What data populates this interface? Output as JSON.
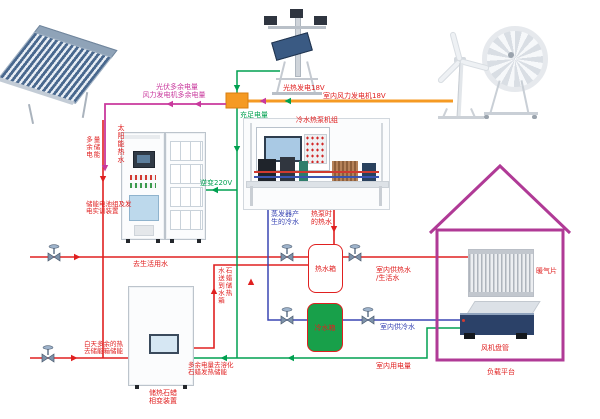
{
  "colors": {
    "red_line": "#e02020",
    "blue_line": "#3a46b4",
    "green_line": "#00a050",
    "orange_line": "#f59a23",
    "magenta_line": "#c9399d",
    "house_outline": "#b03a96",
    "cold_tank_fill": "#18a04a"
  },
  "power": {
    "pv_excess_l1": "光伏多余电量",
    "pv_excess_l2": "风力发电机多余电量",
    "solar_thermal": "光热发电18V",
    "indoor_wind": "室内风力发电机18V",
    "sufficient": "充足电量",
    "excess_storage_c1": "多余电",
    "excess_storage_c2": "量储能",
    "inverter": "逆变220V",
    "indoor_power": "室内用电量",
    "excess_melt_l1": "多余电量去溶化",
    "excess_melt_l2": "石蜡发热储能"
  },
  "water": {
    "solar_hot_water": "太阳能热水",
    "to_domestic": "去生活用水",
    "evap_cold_l1": "蒸发器产",
    "evap_cold_l2": "生的冷水",
    "hp_hot_l1": "热泵时",
    "hp_hot_l2": "的热水",
    "hot_tank": "热水箱",
    "cold_tank": "冷水箱",
    "indoor_hot_l1": "室内供热水",
    "indoor_hot_l2": "/生活水",
    "indoor_cold": "室内供冷水",
    "paraffin_to_tank_c1": "水送到水箱",
    "paraffin_to_tank_c2": "石蜡储热",
    "day_excess_l1": "白天多余的热",
    "day_excess_l2": "去储能箱储能"
  },
  "equipment": {
    "chiller_unit": "冷水热泵机组",
    "battery_l1": "储能电池组及发",
    "battery_l2": "电实训装置",
    "paraffin_l1": "储热石蜡",
    "paraffin_l2": "相变装置",
    "radiator": "暖气片",
    "fan_coil": "风机盘管",
    "load_platform": "负载平台"
  }
}
